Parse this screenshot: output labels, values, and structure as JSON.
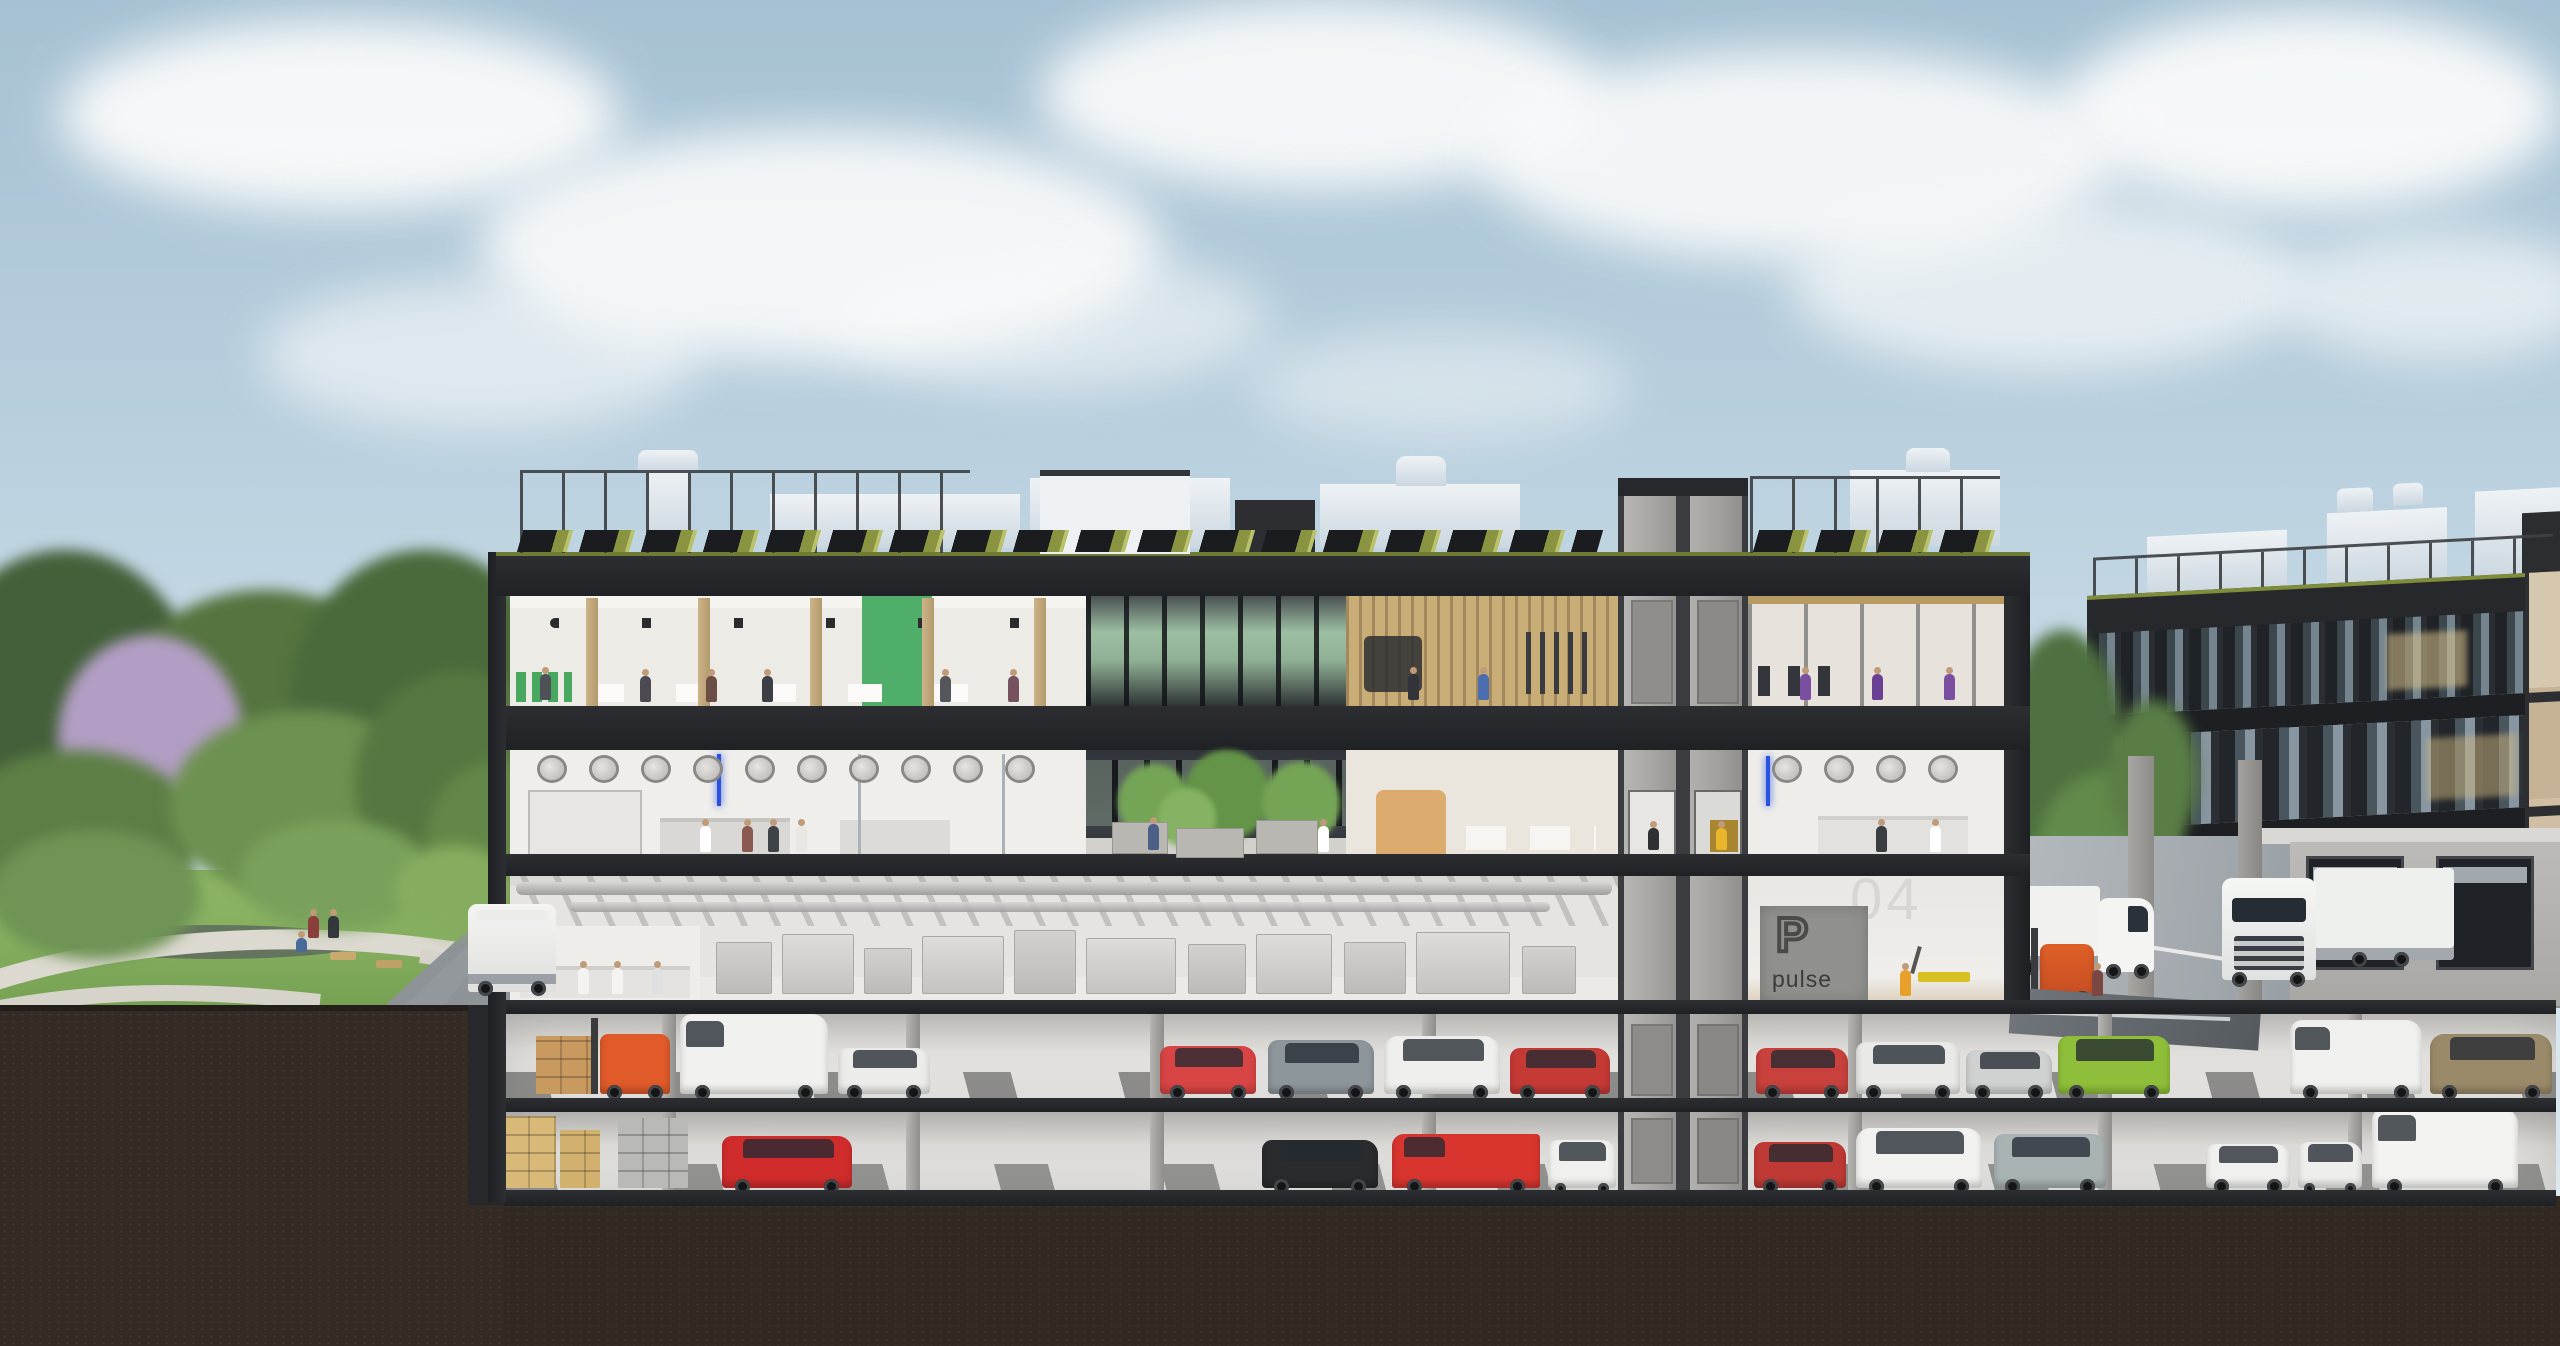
{
  "signage": {
    "parking_logo_letter": "P",
    "parking_brand": "pulse",
    "floor_label": "04"
  },
  "palette": {
    "sky_top": "#a6c1d3",
    "sky_horizon": "#dfe9ef",
    "cloud": "#fafbfb",
    "facade_dark": "#2c2e31",
    "slab_dark": "#202225",
    "interior_white": "#edebe6",
    "wood_column": "#c2a878",
    "green_accent_volume": "#4fae6a",
    "gym_wood_wall": "#c9ad77",
    "core_concrete": "#b2b0ad",
    "core_door": "#908e8b",
    "solar_panel": "#1a1c1f",
    "sedum_green": "#8a9440",
    "lawn": "#84ad5d",
    "path": "#dcd9d0",
    "soil": "#342c24",
    "asphalt": "#9aa1a6",
    "parking_floor": "#dededb",
    "parking_wall": "#c0bfbc",
    "hivis_vest": "#e8b62c",
    "forklift_orange": "#e05a2a",
    "right_building_fin": "#1f2226",
    "right_building_glass": "#75858f",
    "truck_white": "#f1f2f0",
    "sign_panel": "#90908d",
    "sign_text": "#3b3b3b",
    "floor_number_color": "#d8d6d3"
  },
  "scenery": {
    "clouds": [
      {
        "x": 60,
        "y": 20,
        "w": 560,
        "h": 190,
        "o": 0.95
      },
      {
        "x": 480,
        "y": 130,
        "w": 680,
        "h": 230,
        "o": 0.9
      },
      {
        "x": 1040,
        "y": 0,
        "w": 560,
        "h": 190,
        "o": 0.92
      },
      {
        "x": 1480,
        "y": 50,
        "w": 640,
        "h": 210,
        "o": 0.9
      },
      {
        "x": 2060,
        "y": 10,
        "w": 500,
        "h": 200,
        "o": 0.95
      },
      {
        "x": 1790,
        "y": 200,
        "w": 520,
        "h": 170,
        "o": 0.7
      },
      {
        "x": 260,
        "y": 280,
        "w": 440,
        "h": 150,
        "o": 0.6
      },
      {
        "x": 2280,
        "y": 230,
        "w": 320,
        "h": 130,
        "o": 0.65
      },
      {
        "x": 830,
        "y": 250,
        "w": 440,
        "h": 140,
        "o": 0.55
      },
      {
        "x": 1250,
        "y": 330,
        "w": 380,
        "h": 110,
        "o": 0.45
      }
    ],
    "park_trees": [
      {
        "x": -70,
        "y": 550,
        "w": 270,
        "h": 310,
        "c": "#44603a"
      },
      {
        "x": 110,
        "y": 590,
        "w": 310,
        "h": 270,
        "c": "#55743f"
      },
      {
        "x": 290,
        "y": 550,
        "w": 270,
        "h": 310,
        "c": "#4a6a3c"
      },
      {
        "x": 58,
        "y": 635,
        "w": 185,
        "h": 205,
        "c": "#b29ec4"
      },
      {
        "x": -50,
        "y": 750,
        "w": 250,
        "h": 170,
        "c": "#5d7f45"
      },
      {
        "x": 170,
        "y": 710,
        "w": 270,
        "h": 190,
        "c": "#6d9150"
      },
      {
        "x": 355,
        "y": 670,
        "w": 210,
        "h": 230,
        "c": "#567741"
      },
      {
        "x": 425,
        "y": 760,
        "w": 150,
        "h": 170,
        "c": "#638748"
      },
      {
        "x": -10,
        "y": 830,
        "w": 210,
        "h": 130,
        "c": "#6f9455"
      },
      {
        "x": 240,
        "y": 820,
        "w": 190,
        "h": 110,
        "c": "#7aa15b"
      },
      {
        "x": 395,
        "y": 845,
        "w": 120,
        "h": 90,
        "c": "#86ad5f"
      }
    ],
    "gap_trees": [
      {
        "x": 2000,
        "y": 630,
        "w": 126,
        "h": 270,
        "c": "#4f7040"
      },
      {
        "x": 2036,
        "y": 770,
        "w": 146,
        "h": 170,
        "c": "#628a4a"
      },
      {
        "x": 1998,
        "y": 855,
        "w": 96,
        "h": 96,
        "c": "#6f9a55"
      },
      {
        "x": 2108,
        "y": 700,
        "w": 90,
        "h": 150,
        "c": "#5a7d46"
      }
    ],
    "atrium_trees": [
      {
        "x": 1118,
        "y": 764,
        "w": 72,
        "h": 76,
        "c": "#74a455"
      },
      {
        "x": 1184,
        "y": 750,
        "w": 86,
        "h": 90,
        "c": "#639447"
      },
      {
        "x": 1262,
        "y": 762,
        "w": 78,
        "h": 82,
        "c": "#74a455"
      },
      {
        "x": 1158,
        "y": 788,
        "w": 58,
        "h": 60,
        "c": "#85b363"
      }
    ],
    "planters": [
      {
        "x": 1112,
        "y": 822,
        "w": 54,
        "h": 30
      },
      {
        "x": 1176,
        "y": 828,
        "w": 66,
        "h": 28
      },
      {
        "x": 1256,
        "y": 820,
        "w": 60,
        "h": 32
      }
    ]
  },
  "building": {
    "l1_vents": [
      {
        "x": 540,
        "y": 758
      },
      {
        "x": 592,
        "y": 758
      },
      {
        "x": 644,
        "y": 758
      },
      {
        "x": 696,
        "y": 758
      },
      {
        "x": 748,
        "y": 758
      },
      {
        "x": 800,
        "y": 758
      },
      {
        "x": 852,
        "y": 758
      },
      {
        "x": 904,
        "y": 758
      },
      {
        "x": 956,
        "y": 758
      },
      {
        "x": 1008,
        "y": 758
      },
      {
        "x": 1775,
        "y": 758
      },
      {
        "x": 1827,
        "y": 758
      },
      {
        "x": 1879,
        "y": 758
      },
      {
        "x": 1931,
        "y": 758
      }
    ],
    "hall_machines": [
      {
        "x": 716,
        "w": 54,
        "h": 50
      },
      {
        "x": 782,
        "w": 70,
        "h": 58
      },
      {
        "x": 864,
        "w": 46,
        "h": 44
      },
      {
        "x": 922,
        "w": 80,
        "h": 56
      },
      {
        "x": 1014,
        "w": 60,
        "h": 62
      },
      {
        "x": 1086,
        "w": 88,
        "h": 54
      },
      {
        "x": 1188,
        "w": 56,
        "h": 48
      },
      {
        "x": 1256,
        "w": 74,
        "h": 58
      },
      {
        "x": 1344,
        "w": 60,
        "h": 50
      },
      {
        "x": 1416,
        "w": 92,
        "h": 60
      },
      {
        "x": 1522,
        "w": 52,
        "h": 46
      }
    ],
    "wood_columns_x": [
      586,
      698,
      810,
      922,
      1034
    ],
    "parking_columns_x": [
      662,
      906,
      1150,
      1422,
      1848,
      2098,
      2348
    ]
  },
  "vehicles": {
    "parking_p1": [
      {
        "t": "boxes",
        "c": "#c89a5f",
        "x": 536,
        "w": 56,
        "h": 58
      },
      {
        "t": "forklift",
        "c": "#e05a2a",
        "x": 600,
        "w": 70,
        "h": 60
      },
      {
        "t": "van",
        "c": "#f1f1ef",
        "x": 680,
        "w": 148,
        "h": 80
      },
      {
        "t": "car",
        "c": "#ececea",
        "x": 838,
        "w": 92,
        "h": 46
      },
      {
        "t": "car",
        "c": "#d94545",
        "x": 1160,
        "w": 96,
        "h": 48
      },
      {
        "t": "suv",
        "c": "#8d969b",
        "x": 1268,
        "w": 106,
        "h": 54
      },
      {
        "t": "minivan",
        "c": "#efefed",
        "x": 1384,
        "w": 116,
        "h": 58
      },
      {
        "t": "car",
        "c": "#c63a36",
        "x": 1510,
        "w": 100,
        "h": 46
      },
      {
        "t": "car",
        "c": "#c9413d",
        "x": 1756,
        "w": 92,
        "h": 46
      },
      {
        "t": "suv",
        "c": "#e9e9e7",
        "x": 1856,
        "w": 104,
        "h": 52
      },
      {
        "t": "car",
        "c": "#d0d2d1",
        "x": 1966,
        "w": 86,
        "h": 44
      },
      {
        "t": "suv",
        "c": "#8fbf3a",
        "x": 2058,
        "w": 112,
        "h": 58
      },
      {
        "t": "van",
        "c": "#f0f0ee",
        "x": 2290,
        "w": 132,
        "h": 74
      },
      {
        "t": "minivan",
        "c": "#9b8a6a",
        "x": 2430,
        "w": 122,
        "h": 60
      }
    ],
    "parking_p2": [
      {
        "t": "boxes",
        "c": "#d8b978",
        "x": 504,
        "w": 52,
        "h": 72
      },
      {
        "t": "boxes",
        "c": "#d2b06e",
        "x": 560,
        "w": 40,
        "h": 58
      },
      {
        "t": "cabinet",
        "c": "#b9b9b7",
        "x": 618,
        "w": 70,
        "h": 70
      },
      {
        "t": "car",
        "c": "#d02c2c",
        "x": 722,
        "w": 130,
        "h": 52
      },
      {
        "t": "car",
        "c": "#2a2b2d",
        "x": 1262,
        "w": 116,
        "h": 48
      },
      {
        "t": "pickup",
        "c": "#d8352f",
        "x": 1392,
        "w": 148,
        "h": 54
      },
      {
        "t": "car",
        "c": "#f0f0ee",
        "x": 1548,
        "w": 68,
        "h": 48
      },
      {
        "t": "car",
        "c": "#c03a35",
        "x": 1754,
        "w": 92,
        "h": 46
      },
      {
        "t": "minivan",
        "c": "#f2f2f0",
        "x": 1856,
        "w": 126,
        "h": 60
      },
      {
        "t": "suv",
        "c": "#a9b3b4",
        "x": 1994,
        "w": 112,
        "h": 54
      },
      {
        "t": "car",
        "c": "#f0f0ef",
        "x": 2206,
        "w": 84,
        "h": 44
      },
      {
        "t": "car",
        "c": "#eeeeec",
        "x": 2298,
        "w": 64,
        "h": 46
      },
      {
        "t": "sprinter",
        "c": "#f3f3f1",
        "x": 2372,
        "w": 146,
        "h": 80
      }
    ]
  },
  "people": [
    {
      "x": 640,
      "y": 702,
      "c": "#4a4a50"
    },
    {
      "x": 706,
      "y": 702,
      "c": "#6b4f46"
    },
    {
      "x": 762,
      "y": 702,
      "c": "#3c3f45"
    },
    {
      "x": 940,
      "y": 702,
      "c": "#54565c"
    },
    {
      "x": 1008,
      "y": 702,
      "c": "#75525e"
    },
    {
      "x": 540,
      "y": 700,
      "c": "#4e5258"
    },
    {
      "x": 1408,
      "y": 700,
      "c": "#33343a"
    },
    {
      "x": 1478,
      "y": 700,
      "c": "#4b6fae"
    },
    {
      "x": 1800,
      "y": 700,
      "c": "#7b4fa0"
    },
    {
      "x": 1872,
      "y": 700,
      "c": "#6a4094"
    },
    {
      "x": 1944,
      "y": 700,
      "c": "#7b4fa0"
    },
    {
      "x": 700,
      "y": 852,
      "c": "#ffffff"
    },
    {
      "x": 742,
      "y": 852,
      "c": "#8a5a50"
    },
    {
      "x": 768,
      "y": 852,
      "c": "#3f4247"
    },
    {
      "x": 796,
      "y": 852,
      "c": "#e9e7e4"
    },
    {
      "x": 1318,
      "y": 852,
      "c": "#ffffff"
    },
    {
      "x": 1876,
      "y": 852,
      "c": "#3a3d42"
    },
    {
      "x": 1930,
      "y": 852,
      "c": "#ffffff"
    },
    {
      "x": 1148,
      "y": 850,
      "c": "#4b5f87"
    },
    {
      "x": 578,
      "y": 994,
      "c": "#f4f3f1"
    },
    {
      "x": 612,
      "y": 994,
      "c": "#f4f3f1"
    },
    {
      "x": 652,
      "y": 994,
      "c": "#dfe0e2"
    },
    {
      "x": 1900,
      "y": 996,
      "c": "#e8a02c"
    },
    {
      "x": 2092,
      "y": 996,
      "c": "#7a4742"
    },
    {
      "x": 308,
      "y": 938,
      "c": "#8a3f3c",
      "h": 22
    },
    {
      "x": 328,
      "y": 938,
      "c": "#34383d",
      "h": 22
    },
    {
      "x": 296,
      "y": 952,
      "c": "#4a6a9a",
      "h": 14
    },
    {
      "x": 1648,
      "y": 850,
      "c": "#2e3033",
      "h": 22
    },
    {
      "x": 1716,
      "y": 850,
      "c": "#e8b62c",
      "h": 22
    }
  ]
}
